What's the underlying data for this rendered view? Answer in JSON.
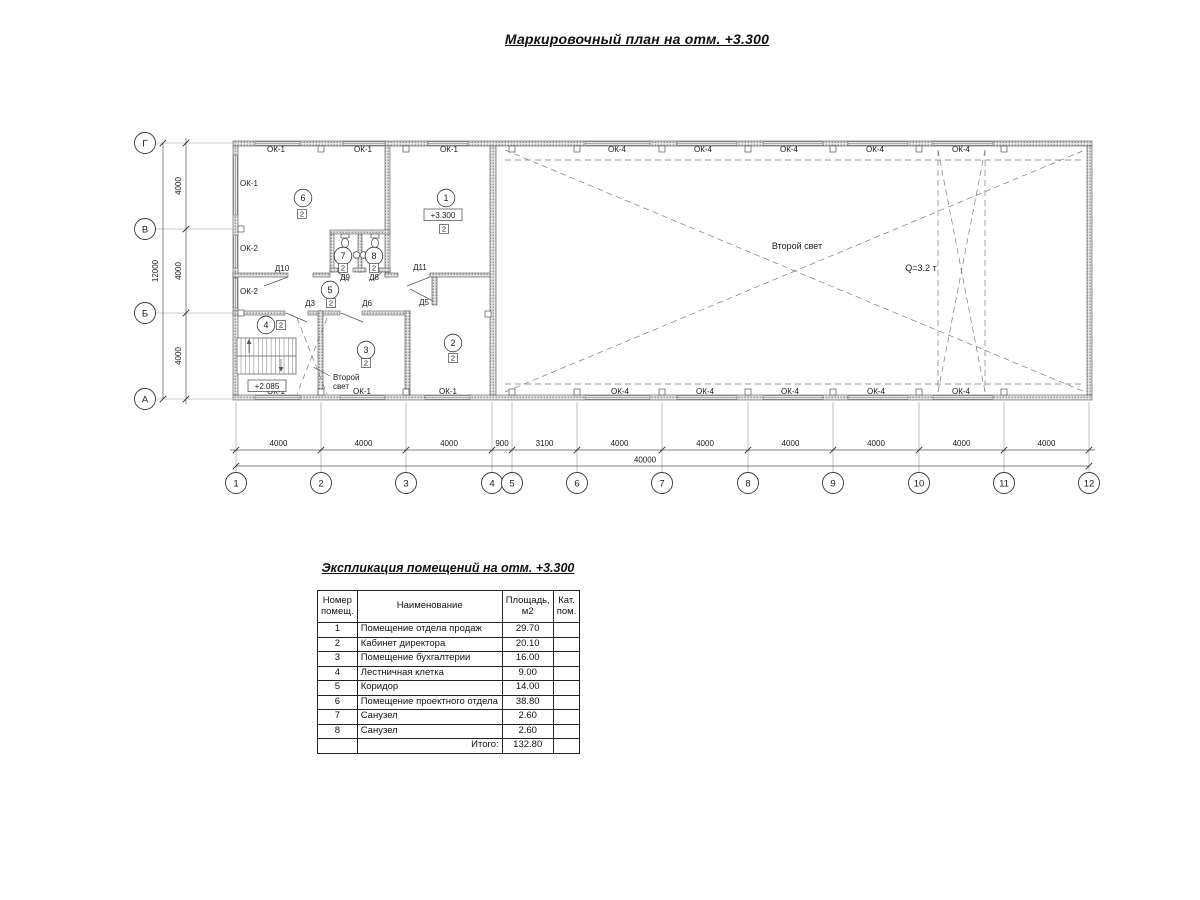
{
  "page": {
    "title": "Маркировочный план на отм. +3.300"
  },
  "plan": {
    "window_labels": [
      {
        "t": "ОК-1",
        "x": 276,
        "y": 152
      },
      {
        "t": "ОК-1",
        "x": 363,
        "y": 152
      },
      {
        "t": "ОК-1",
        "x": 449,
        "y": 152
      },
      {
        "t": "ОК-4",
        "x": 617,
        "y": 152
      },
      {
        "t": "ОК-4",
        "x": 703,
        "y": 152
      },
      {
        "t": "ОК-4",
        "x": 789,
        "y": 152
      },
      {
        "t": "ОК-4",
        "x": 875,
        "y": 152
      },
      {
        "t": "ОК-4",
        "x": 961,
        "y": 152
      },
      {
        "t": "ОК-1",
        "x": 276,
        "y": 394
      },
      {
        "t": "ОК-1",
        "x": 362,
        "y": 394
      },
      {
        "t": "ОК-1",
        "x": 448,
        "y": 394
      },
      {
        "t": "ОК-4",
        "x": 620,
        "y": 394
      },
      {
        "t": "ОК-4",
        "x": 705,
        "y": 394
      },
      {
        "t": "ОК-4",
        "x": 790,
        "y": 394
      },
      {
        "t": "ОК-4",
        "x": 876,
        "y": 394
      },
      {
        "t": "ОК-4",
        "x": 961,
        "y": 394
      },
      {
        "t": "ОК-1",
        "x": 240,
        "y": 186,
        "a": "start"
      },
      {
        "t": "ОК-2",
        "x": 240,
        "y": 251,
        "a": "start"
      },
      {
        "t": "ОК-2",
        "x": 240,
        "y": 294,
        "a": "start"
      }
    ],
    "door_labels": [
      {
        "t": "Д10",
        "x": 282,
        "y": 271
      },
      {
        "t": "Д11",
        "x": 420,
        "y": 270
      },
      {
        "t": "Д9",
        "x": 345,
        "y": 280
      },
      {
        "t": "Д8",
        "x": 374,
        "y": 280
      },
      {
        "t": "Д3",
        "x": 310,
        "y": 306
      },
      {
        "t": "Д6",
        "x": 367,
        "y": 306
      },
      {
        "t": "Д5",
        "x": 424,
        "y": 305
      }
    ],
    "rooms": [
      {
        "n": "6",
        "cx": 303,
        "cy": 198,
        "bx": 302,
        "by": 214
      },
      {
        "n": "1",
        "cx": 446,
        "cy": 198,
        "bx": 444,
        "by": 229
      },
      {
        "n": "7",
        "cx": 343,
        "cy": 256,
        "bx": 343,
        "by": 268
      },
      {
        "n": "8",
        "cx": 374,
        "cy": 256,
        "bx": 374,
        "by": 268
      },
      {
        "n": "5",
        "cx": 330,
        "cy": 290,
        "bx": 331,
        "by": 303
      },
      {
        "n": "4",
        "cx": 266,
        "cy": 325,
        "bx": 281,
        "by": 325
      },
      {
        "n": "3",
        "cx": 366,
        "cy": 350,
        "bx": 366,
        "by": 363
      },
      {
        "n": "2",
        "cx": 453,
        "cy": 343,
        "bx": 453,
        "by": 358
      }
    ],
    "category_value": "2",
    "elevations": [
      {
        "t": "+3.300",
        "x": 443,
        "y": 215
      },
      {
        "t": "+2.085",
        "x": 267,
        "y": 386
      }
    ],
    "annotations": [
      {
        "t": "Второй свет",
        "x": 797,
        "y": 249,
        "fs": 9
      },
      {
        "t": "Q=3.2 т",
        "x": 921,
        "y": 271,
        "fs": 9
      },
      {
        "t": "Второй",
        "x": 333,
        "y": 380,
        "fs": 8,
        "a": "start"
      },
      {
        "t": "свет",
        "x": 333,
        "y": 389,
        "fs": 8,
        "a": "start"
      }
    ],
    "axes": [
      {
        "l": "Г",
        "y": 143
      },
      {
        "l": "В",
        "y": 229
      },
      {
        "l": "Б",
        "y": 313
      },
      {
        "l": "А",
        "y": 399
      }
    ],
    "grids": [
      {
        "l": "1",
        "x": 236
      },
      {
        "l": "2",
        "x": 321
      },
      {
        "l": "3",
        "x": 406
      },
      {
        "l": "4",
        "x": 492
      },
      {
        "l": "5",
        "x": 512
      },
      {
        "l": "6",
        "x": 577
      },
      {
        "l": "7",
        "x": 662
      },
      {
        "l": "8",
        "x": 748
      },
      {
        "l": "9",
        "x": 833
      },
      {
        "l": "10",
        "x": 919
      },
      {
        "l": "11",
        "x": 1004
      },
      {
        "l": "12",
        "x": 1089
      }
    ],
    "h_dims": [
      "4000",
      "4000",
      "4000",
      "900",
      "3100",
      "4000",
      "4000",
      "4000",
      "4000",
      "4000",
      "4000"
    ],
    "v_dims": [
      "4000",
      "4000",
      "4000"
    ],
    "h_total": "40000",
    "v_total": "12000"
  },
  "explication": {
    "title": "Экспликация помещений на отм. +3.300",
    "headers": {
      "num": "Номер помещ.",
      "name": "Наименование",
      "area": "Площадь, м2",
      "cat": "Кат. пом."
    },
    "rows": [
      {
        "num": "1",
        "name": "Помещение отдела продаж",
        "area": "29.70",
        "cat": ""
      },
      {
        "num": "2",
        "name": "Кабинет директора",
        "area": "20.10",
        "cat": ""
      },
      {
        "num": "3",
        "name": "Помещение бухгалтерии",
        "area": "16.00",
        "cat": ""
      },
      {
        "num": "4",
        "name": "Лестничная клетка",
        "area": "9.00",
        "cat": ""
      },
      {
        "num": "5",
        "name": "Коридор",
        "area": "14.00",
        "cat": ""
      },
      {
        "num": "6",
        "name": "Помещение проектного отдела",
        "area": "38.80",
        "cat": ""
      },
      {
        "num": "7",
        "name": "Санузел",
        "area": "2.60",
        "cat": ""
      },
      {
        "num": "8",
        "name": "Санузел",
        "area": "2.60",
        "cat": ""
      }
    ],
    "total_label": "Итого:",
    "total_value": "132.80"
  }
}
